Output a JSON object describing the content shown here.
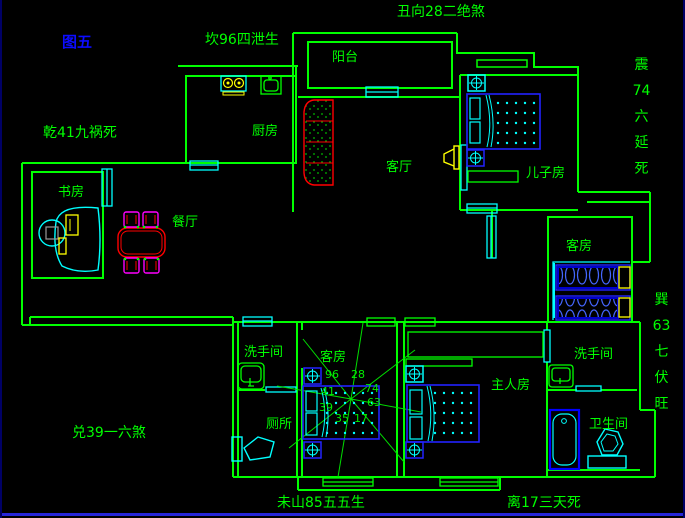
{
  "figure": {
    "label": "图五"
  },
  "fengshui": {
    "chou_top": "丑向28二绝煞",
    "kan": "坎96四泄生",
    "qian": "乾41九祸死",
    "zhen_vertical": "震74六延死",
    "xun_vertical": "巽63七伏旺",
    "dui": "兑39一六煞",
    "wei_bottom": "未山85五五生",
    "li_bottom": "离17三天死"
  },
  "rooms": {
    "balcony": "阳台",
    "kitchen": "厨房",
    "living_room": "客厅",
    "son_bedroom": "儿子房",
    "study": "书房",
    "dining_room": "餐厅",
    "guest_room_east": "客房",
    "guest_room_center": "客房",
    "washroom_west": "洗手间",
    "washroom_east": "洗手间",
    "toilet": "厕所",
    "master_bedroom": "主人房",
    "bathroom": "卫生间"
  },
  "compass": {
    "numbers": [
      "96",
      "28",
      "41",
      "74",
      "39",
      "63",
      "35",
      "17"
    ]
  },
  "colors": {
    "wall": "#00ff00",
    "window": "#00ffff",
    "furniture_blue": "#2222ff",
    "mattress_fill": "#000099",
    "accent_yellow": "#ffff00",
    "accent_red": "#ff0000",
    "accent_magenta": "#ff00ff",
    "figure_label_blue": "#0c0cff",
    "background": "#000000",
    "bottom_border": "#2626d8"
  }
}
